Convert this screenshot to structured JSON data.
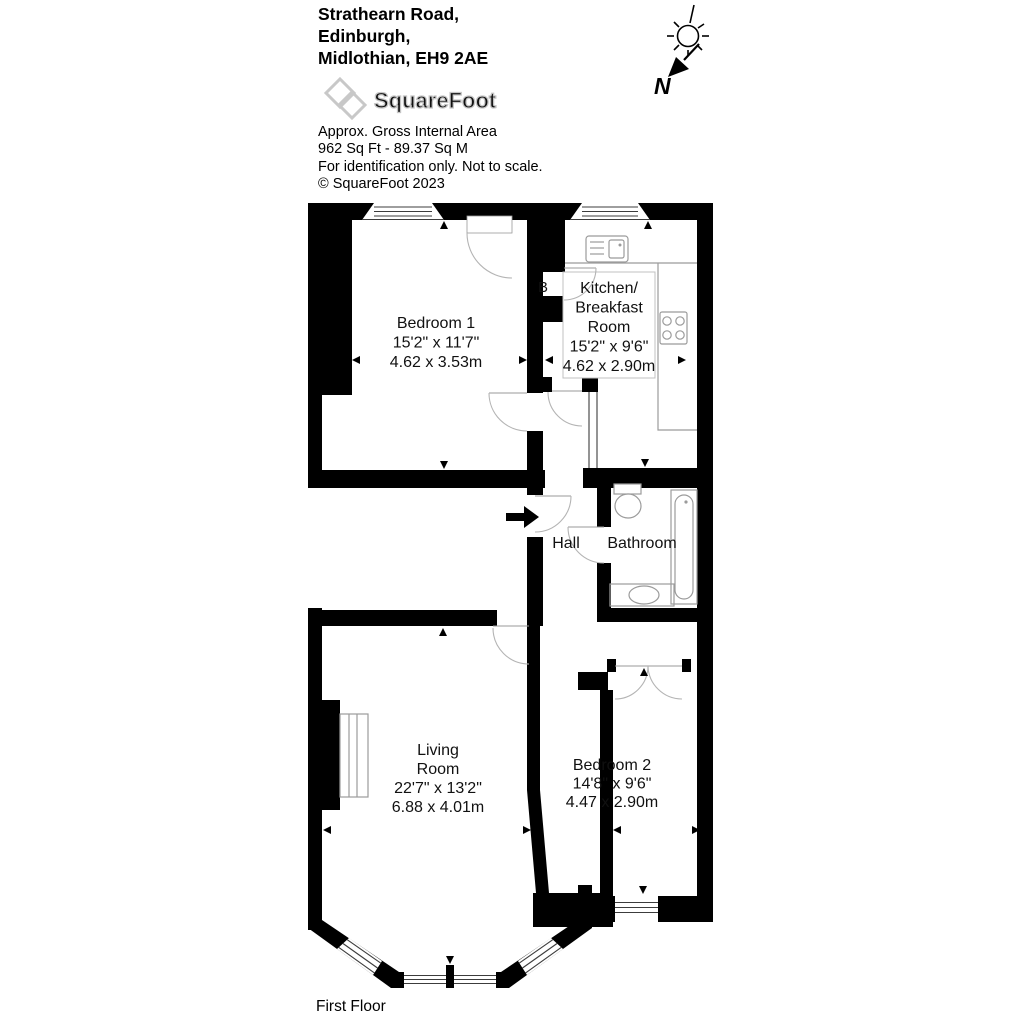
{
  "header": {
    "address_line1": "Strathearn Road,",
    "address_line2": "Edinburgh,",
    "address_line3": "Midlothian, EH9 2AE",
    "logo_text": "SquareFoot",
    "area_title": "Approx. Gross Internal Area",
    "area_value": "962 Sq Ft  -  89.37 Sq M",
    "disclaimer": "For identification only. Not to scale.",
    "copyright": "© SquareFoot 2023"
  },
  "compass": {
    "north_label": "N"
  },
  "floor_label": "First Floor",
  "rooms": {
    "bedroom1": {
      "name": "Bedroom 1",
      "dims_imperial": "15'2\" x 11'7\"",
      "dims_metric": "4.62 x 3.53m"
    },
    "kitchen": {
      "name_line1": "Kitchen/",
      "name_line2": "Breakfast",
      "name_line3": "Room",
      "dims_imperial": "15'2\" x 9'6\"",
      "dims_metric": "4.62 x 2.90m"
    },
    "hall": {
      "name": "Hall"
    },
    "bathroom": {
      "name": "Bathroom"
    },
    "living_room": {
      "name_line1": "Living",
      "name_line2": "Room",
      "dims_imperial": "22'7\" x 13'2\"",
      "dims_metric": "6.88 x 4.01m"
    },
    "bedroom2": {
      "name": "Bedroom 2",
      "dims_imperial": "14'8\" x 9'6\"",
      "dims_metric": "4.47 x 2.90m"
    },
    "boiler_cupboard": {
      "label": "B"
    }
  },
  "colors": {
    "walls": "#000000",
    "door_arc": "#b4b4b4",
    "fixture_stroke": "#9b9b9b",
    "logo_gray": "#c8c8c8",
    "text": "#000000"
  }
}
